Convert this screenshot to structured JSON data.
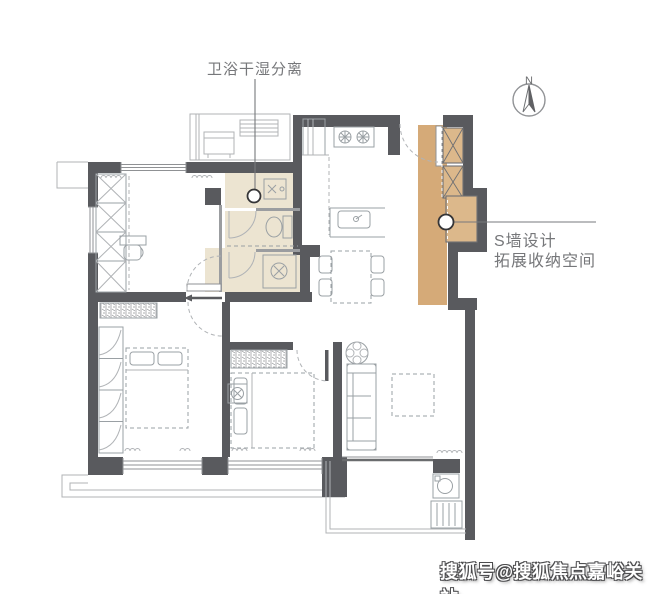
{
  "callouts": {
    "bathroom": "卫浴干湿分离",
    "s_wall_line1": "S墙设计",
    "s_wall_line2": "拓展收纳空间"
  },
  "compass": {
    "north": "N"
  },
  "watermark": {
    "text": "搜狐号@搜狐焦点嘉峪关站"
  },
  "colors": {
    "wall": "#595a5e",
    "bath_floor": "#ece4d1",
    "storage_strip": "#d5aa78",
    "storage_cabinet": "#dcb88b",
    "label_text": "#76777a",
    "furniture_line": "#9aa0a4"
  }
}
